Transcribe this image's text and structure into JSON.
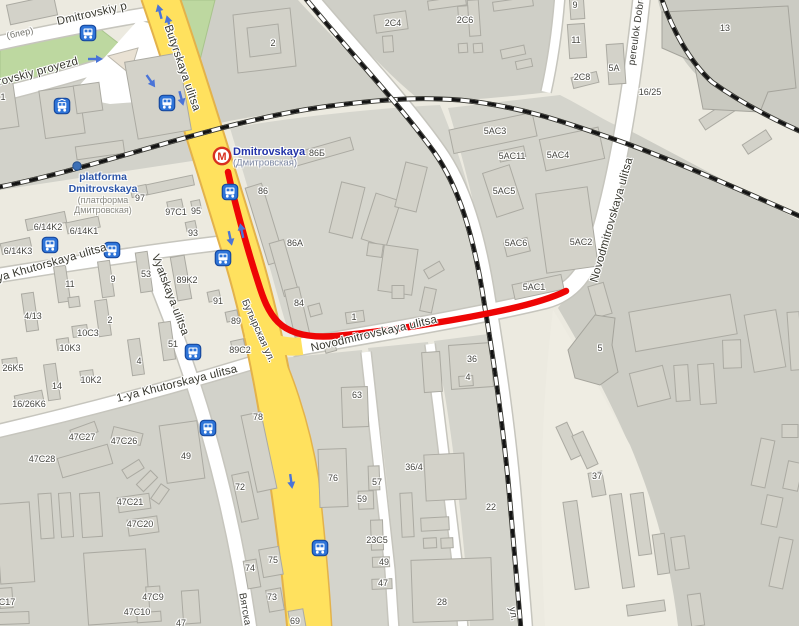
{
  "map": {
    "title": "Dmitrovskaya area map",
    "colors": {
      "route_red": "#ee0505",
      "road_yellow": "#ffe15e",
      "road_yellow_casing": "#e3b24b",
      "park_green": "#bdd8a0",
      "rail_black": "#141414",
      "transit_blue": "#2e74d8",
      "metro_red": "#d8301f"
    },
    "metro": {
      "name": "Dmitrovskaya",
      "name_local": "(Дмитровская)",
      "x": 222,
      "y": 156
    },
    "platform": {
      "name_lines": [
        "platforma",
        "Dmitrovskaya"
      ],
      "local_lines": [
        "(платформа",
        "Дмитровская)"
      ],
      "x": 103,
      "y": 171,
      "dot_x": 77,
      "dot_y": 166
    },
    "streets": [
      {
        "text": "Dmitrovskiy p",
        "x": 92,
        "y": 14,
        "rot": -13,
        "cls": "big"
      },
      {
        "text": "rovskiy proyezd",
        "x": 38,
        "y": 72,
        "rot": -15,
        "cls": "big"
      },
      {
        "text": "(блер)",
        "x": 20,
        "y": 33,
        "rot": -12,
        "cls": "small"
      },
      {
        "text": "Butyrskaya ulitsa",
        "x": 182,
        "y": 68,
        "rot": 71,
        "cls": "big"
      },
      {
        "text": "Бутырская ул.",
        "x": 258,
        "y": 331,
        "rot": 66,
        "cls": ""
      },
      {
        "text": "Novodmitrovskaya ulitsa",
        "x": 374,
        "y": 334,
        "rot": -13,
        "cls": "big"
      },
      {
        "text": "Novodmitrovskaya ulitsa",
        "x": 612,
        "y": 220,
        "rot": -74,
        "cls": "big"
      },
      {
        "text": "pereulok Dobro",
        "x": 637,
        "y": 30,
        "rot": -82,
        "cls": ""
      },
      {
        "text": "ya Khutorskaya ulitsa",
        "x": 52,
        "y": 263,
        "rot": -16,
        "cls": "big"
      },
      {
        "text": "1-ya Khutorskaya ulitsa",
        "x": 177,
        "y": 384,
        "rot": -14,
        "cls": "big"
      },
      {
        "text": "Vyatskaya ulitsa",
        "x": 170,
        "y": 295,
        "rot": 69,
        "cls": "big"
      },
      {
        "text": "Вятская",
        "x": 245,
        "y": 612,
        "rot": 80,
        "cls": ""
      },
      {
        "text": "ул.",
        "x": 513,
        "y": 614,
        "rot": 80,
        "cls": ""
      }
    ],
    "buildings": [
      {
        "text": "2C4",
        "x": 393,
        "y": 23
      },
      {
        "text": "2C6",
        "x": 465,
        "y": 20
      },
      {
        "text": "9",
        "x": 575,
        "y": 5
      },
      {
        "text": "11",
        "x": 576,
        "y": 40
      },
      {
        "text": "5A",
        "x": 614,
        "y": 68
      },
      {
        "text": "2C8",
        "x": 582,
        "y": 77
      },
      {
        "text": "13",
        "x": 725,
        "y": 28
      },
      {
        "text": "16/25",
        "x": 650,
        "y": 92
      },
      {
        "text": "2",
        "x": 273,
        "y": 43
      },
      {
        "text": "5AC3",
        "x": 495,
        "y": 131
      },
      {
        "text": "5AC11",
        "x": 512,
        "y": 156
      },
      {
        "text": "5AC4",
        "x": 558,
        "y": 155
      },
      {
        "text": "5AC5",
        "x": 504,
        "y": 191
      },
      {
        "text": "5AC6",
        "x": 516,
        "y": 243
      },
      {
        "text": "5AC2",
        "x": 581,
        "y": 242
      },
      {
        "text": "5AC1",
        "x": 534,
        "y": 287
      },
      {
        "text": "5",
        "x": 600,
        "y": 348
      },
      {
        "text": "37",
        "x": 597,
        "y": 476
      },
      {
        "text": "86Б",
        "x": 317,
        "y": 153
      },
      {
        "text": "86",
        "x": 263,
        "y": 191
      },
      {
        "text": "86A",
        "x": 295,
        "y": 243
      },
      {
        "text": "84",
        "x": 299,
        "y": 303
      },
      {
        "text": "1",
        "x": 354,
        "y": 317
      },
      {
        "text": "97",
        "x": 140,
        "y": 198
      },
      {
        "text": "97C1",
        "x": 176,
        "y": 212
      },
      {
        "text": "95",
        "x": 196,
        "y": 211
      },
      {
        "text": "93",
        "x": 193,
        "y": 233
      },
      {
        "text": "6/14K2",
        "x": 48,
        "y": 227
      },
      {
        "text": "6/14K1",
        "x": 84,
        "y": 231
      },
      {
        "text": "6/14K3",
        "x": 18,
        "y": 251
      },
      {
        "text": "11",
        "x": 70,
        "y": 284
      },
      {
        "text": "9",
        "x": 113,
        "y": 279
      },
      {
        "text": "53",
        "x": 146,
        "y": 274
      },
      {
        "text": "89K2",
        "x": 187,
        "y": 280
      },
      {
        "text": "91",
        "x": 218,
        "y": 301
      },
      {
        "text": "89",
        "x": 236,
        "y": 321
      },
      {
        "text": "89C2",
        "x": 240,
        "y": 350
      },
      {
        "text": "4/13",
        "x": 33,
        "y": 316
      },
      {
        "text": "2",
        "x": 110,
        "y": 320
      },
      {
        "text": "10C3",
        "x": 88,
        "y": 333
      },
      {
        "text": "10K3",
        "x": 70,
        "y": 348
      },
      {
        "text": "51",
        "x": 173,
        "y": 344
      },
      {
        "text": "4",
        "x": 139,
        "y": 361
      },
      {
        "text": "10K2",
        "x": 91,
        "y": 380
      },
      {
        "text": "14",
        "x": 57,
        "y": 386
      },
      {
        "text": "26K5",
        "x": 13,
        "y": 368
      },
      {
        "text": "16/26K6",
        "x": 29,
        "y": 404
      },
      {
        "text": "47C27",
        "x": 82,
        "y": 437
      },
      {
        "text": "47C26",
        "x": 124,
        "y": 441
      },
      {
        "text": "47C28",
        "x": 42,
        "y": 459
      },
      {
        "text": "49",
        "x": 186,
        "y": 456
      },
      {
        "text": "78",
        "x": 258,
        "y": 417
      },
      {
        "text": "72",
        "x": 240,
        "y": 487
      },
      {
        "text": "47C21",
        "x": 130,
        "y": 502
      },
      {
        "text": "47C20",
        "x": 140,
        "y": 524
      },
      {
        "text": "C17",
        "x": 7,
        "y": 602
      },
      {
        "text": "47C9",
        "x": 153,
        "y": 597
      },
      {
        "text": "47C10",
        "x": 137,
        "y": 612
      },
      {
        "text": "47",
        "x": 181,
        "y": 623
      },
      {
        "text": "63",
        "x": 357,
        "y": 395
      },
      {
        "text": "76",
        "x": 333,
        "y": 478
      },
      {
        "text": "57",
        "x": 377,
        "y": 482
      },
      {
        "text": "59",
        "x": 362,
        "y": 499
      },
      {
        "text": "36/4",
        "x": 414,
        "y": 467
      },
      {
        "text": "22",
        "x": 491,
        "y": 507
      },
      {
        "text": "23C5",
        "x": 377,
        "y": 540
      },
      {
        "text": "49",
        "x": 384,
        "y": 562
      },
      {
        "text": "47",
        "x": 383,
        "y": 583
      },
      {
        "text": "75",
        "x": 273,
        "y": 560
      },
      {
        "text": "74",
        "x": 250,
        "y": 568
      },
      {
        "text": "73",
        "x": 272,
        "y": 597
      },
      {
        "text": "69",
        "x": 295,
        "y": 621
      },
      {
        "text": "28",
        "x": 442,
        "y": 602
      },
      {
        "text": "36",
        "x": 472,
        "y": 359
      },
      {
        "text": "4",
        "x": 468,
        "y": 377
      },
      {
        "text": "1",
        "x": 3,
        "y": 97
      }
    ],
    "stops": [
      {
        "type": "bus",
        "x": 88,
        "y": 33
      },
      {
        "type": "tram",
        "x": 62,
        "y": 106
      },
      {
        "type": "bus",
        "x": 167,
        "y": 103
      },
      {
        "type": "bus",
        "x": 230,
        "y": 192
      },
      {
        "type": "bus",
        "x": 223,
        "y": 258
      },
      {
        "type": "bus",
        "x": 50,
        "y": 245
      },
      {
        "type": "bus",
        "x": 112,
        "y": 250
      },
      {
        "type": "bus",
        "x": 193,
        "y": 352
      },
      {
        "type": "bus",
        "x": 208,
        "y": 428
      },
      {
        "type": "bus",
        "x": 320,
        "y": 548
      }
    ],
    "arrows": [
      {
        "x": 94,
        "y": 59,
        "angle": 0
      },
      {
        "x": 150,
        "y": 80,
        "angle": 55
      },
      {
        "x": 160,
        "y": 13,
        "angle": -105
      },
      {
        "x": 169,
        "y": 24,
        "angle": -105
      },
      {
        "x": 181,
        "y": 97,
        "angle": 75
      },
      {
        "x": 230,
        "y": 237,
        "angle": 78
      },
      {
        "x": 242,
        "y": 232,
        "angle": -102
      },
      {
        "x": 291,
        "y": 480,
        "angle": 82
      }
    ]
  }
}
